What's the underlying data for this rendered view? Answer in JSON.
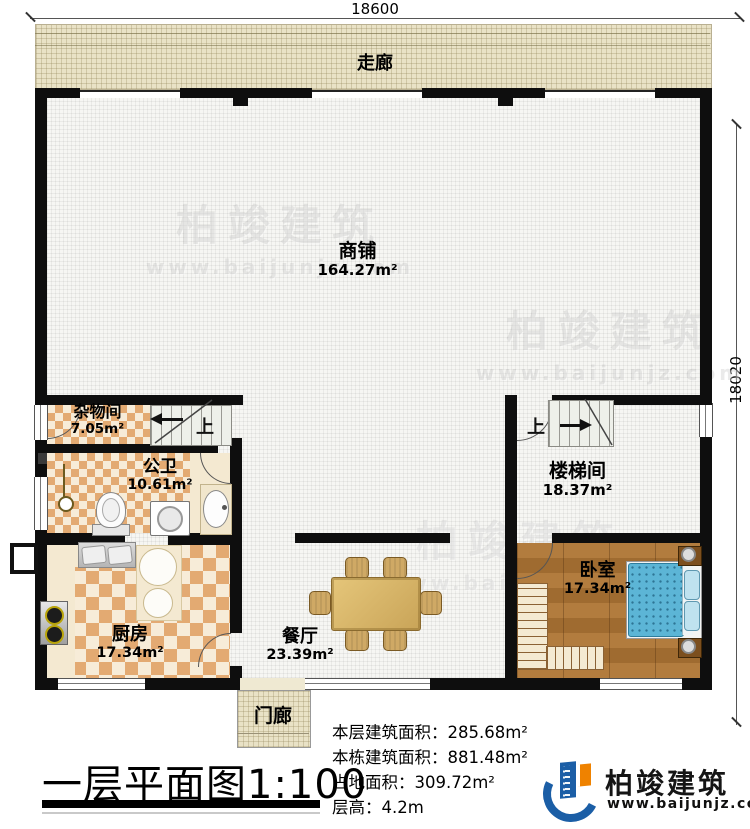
{
  "dimensions": {
    "width_top": "18600",
    "height_right": "18020"
  },
  "rooms": {
    "corridor": {
      "name": "走廊"
    },
    "shop": {
      "name": "商铺",
      "area": "164.27m²"
    },
    "storage": {
      "name": "杂物间",
      "area": "7.05m²"
    },
    "bathroom": {
      "name": "公卫",
      "area": "10.61m²"
    },
    "kitchen": {
      "name": "厨房",
      "area": "17.34m²"
    },
    "dining": {
      "name": "餐厅",
      "area": "23.39m²"
    },
    "stairwell": {
      "name": "楼梯间",
      "area": "18.37m²"
    },
    "bedroom": {
      "name": "卧室",
      "area": "17.34m²"
    },
    "porch": {
      "name": "门廊"
    }
  },
  "stairs": {
    "up": "上"
  },
  "title": {
    "text": "一层平面图",
    "scale": "1:100"
  },
  "stats": [
    {
      "label": "本层建筑面积：",
      "value": "285.68m²"
    },
    {
      "label": "本栋建筑面积：",
      "value": "881.48m²"
    },
    {
      "label": "占地面积：",
      "value": "309.72m²"
    },
    {
      "label": "层高：",
      "value": "4.2m"
    }
  ],
  "brand": {
    "name": "柏竣建筑",
    "website": "www.baijunjz.com"
  },
  "watermark": {
    "name": "柏竣建筑",
    "website": "www.baijunjz.com"
  },
  "colors": {
    "wall": "#0e0e0e",
    "corridor": "#e9e2c6",
    "tile": "#e3aa72",
    "wood": "#aa753a",
    "bed": "#5cb5d6",
    "brand_blue": "#1b5ea6",
    "brand_orange": "#ef8200"
  }
}
